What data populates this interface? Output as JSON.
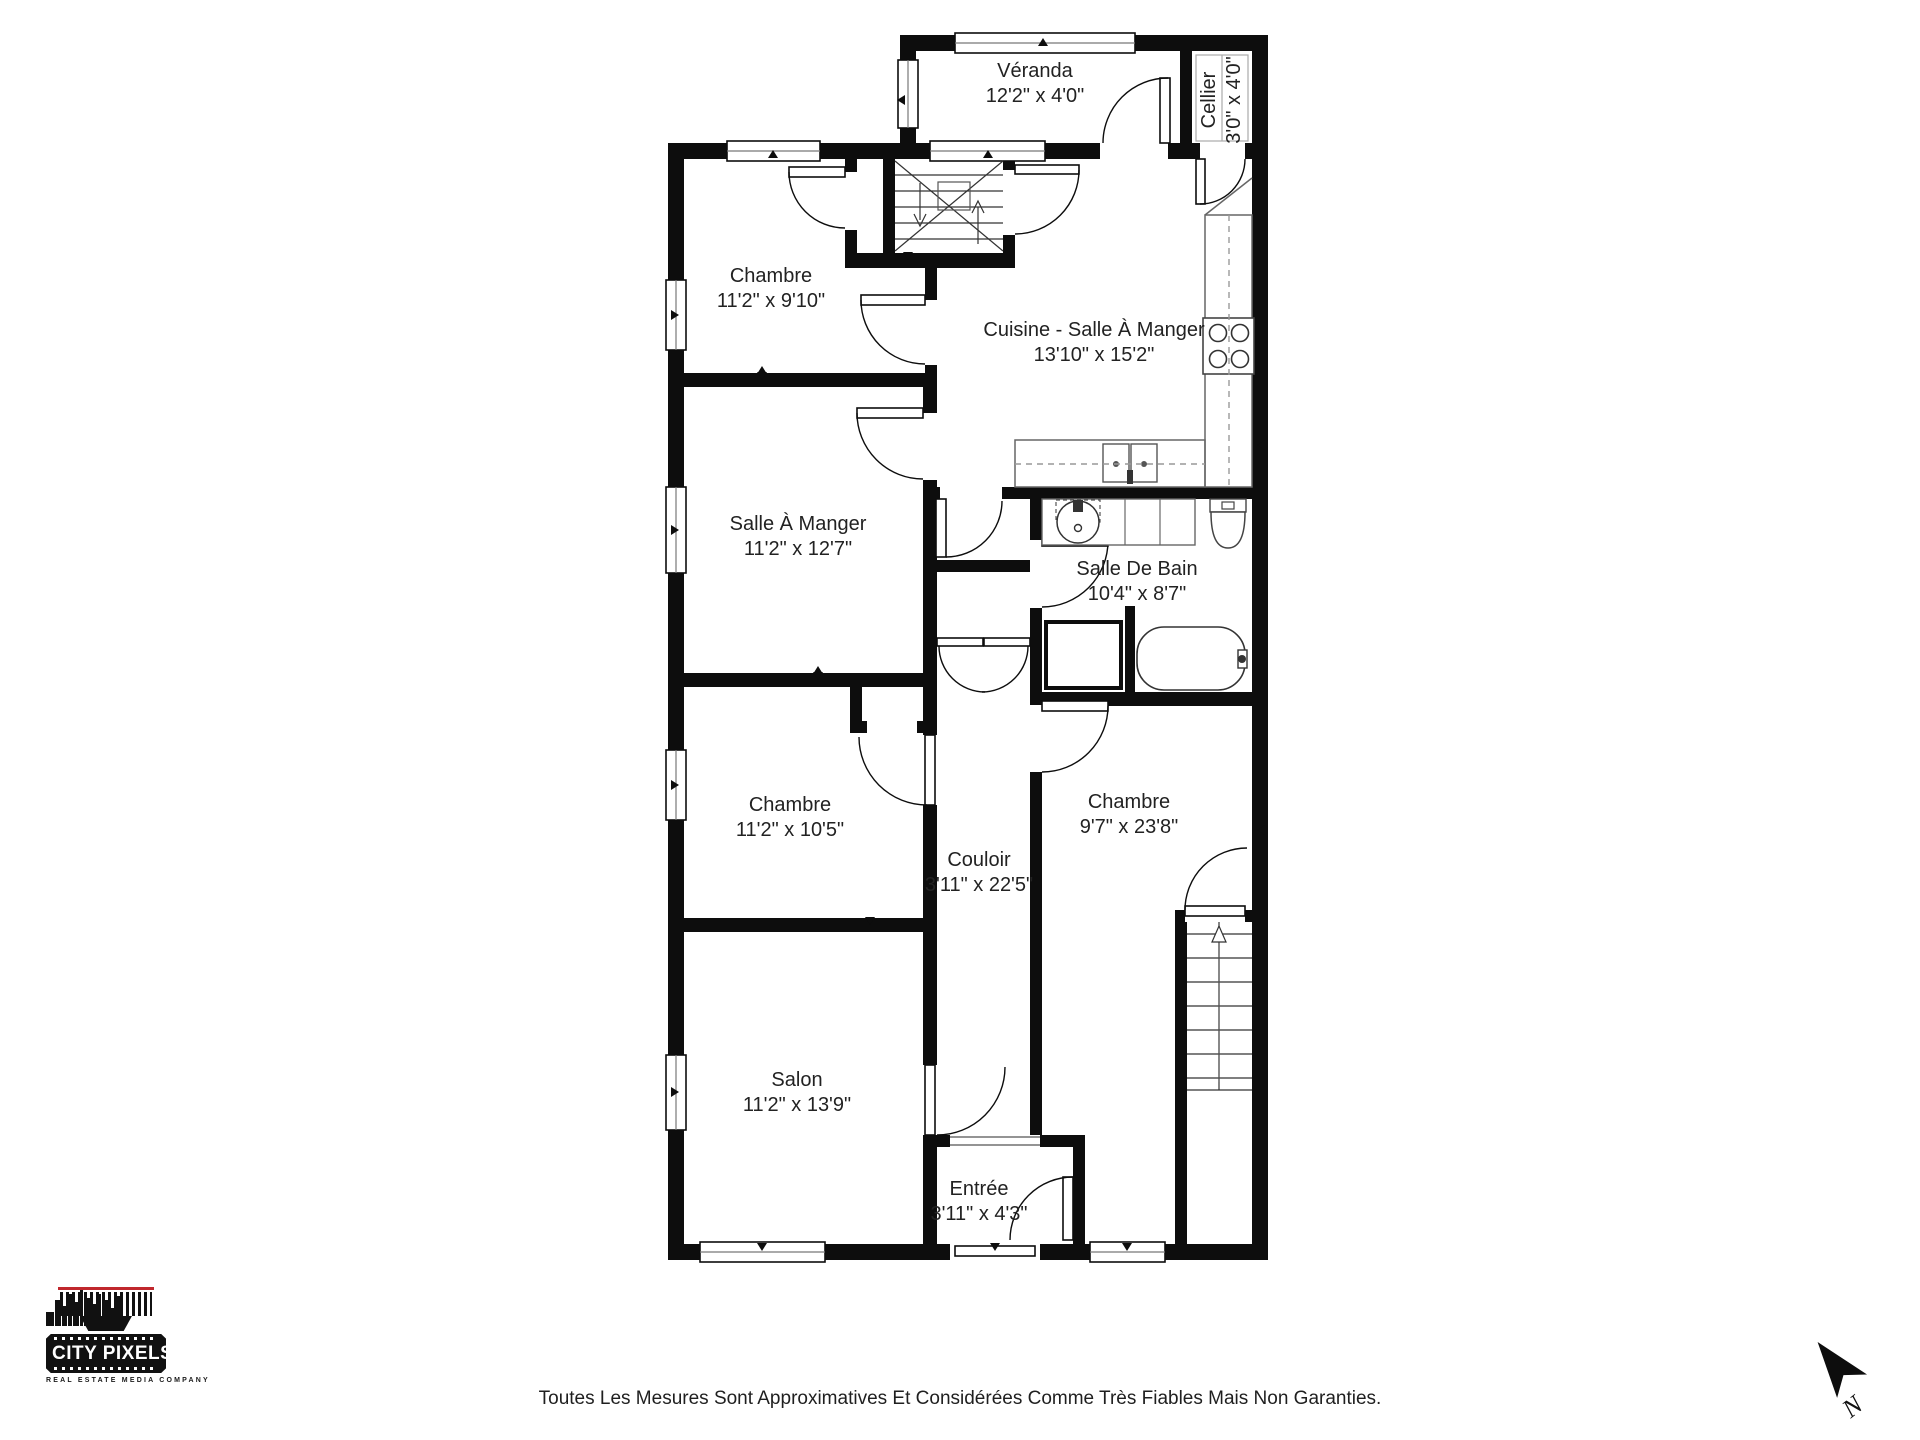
{
  "rooms": [
    {
      "id": "veranda",
      "name": "Véranda",
      "dims": "12'2\" x 4'0\""
    },
    {
      "id": "cellier",
      "name": "Cellier",
      "dims": "3'0\" x 4'0\""
    },
    {
      "id": "chambre1",
      "name": "Chambre",
      "dims": "11'2\" x 9'10\""
    },
    {
      "id": "cuisine",
      "name": "Cuisine - Salle À Manger",
      "dims": "13'10\" x 15'2\""
    },
    {
      "id": "salle_a_manger",
      "name": "Salle À Manger",
      "dims": "11'2\" x 12'7\""
    },
    {
      "id": "salle_de_bain",
      "name": "Salle De Bain",
      "dims": "10'4\" x 8'7\""
    },
    {
      "id": "chambre2",
      "name": "Chambre",
      "dims": "11'2\" x 10'5\""
    },
    {
      "id": "couloir",
      "name": "Couloir",
      "dims": "3'11\" x 22'5\""
    },
    {
      "id": "chambre3",
      "name": "Chambre",
      "dims": "9'7\" x 23'8\""
    },
    {
      "id": "salon",
      "name": "Salon",
      "dims": "11'2\" x 13'9\""
    },
    {
      "id": "entree",
      "name": "Entrée",
      "dims": "3'11\" x 4'3\""
    }
  ],
  "branding": {
    "logo_title": "CITY PIXELS",
    "logo_tagline": "REAL ESTATE MEDIA COMPANY"
  },
  "footer": {
    "disclaimer": "Toutes Les Mesures Sont Approximatives Et Considérées Comme Très Fiables Mais Non Garanties."
  },
  "compass": {
    "label": "N"
  },
  "colors": {
    "wall": "#0d0d0d",
    "accent_red": "#c0272d",
    "background": "#ffffff"
  }
}
